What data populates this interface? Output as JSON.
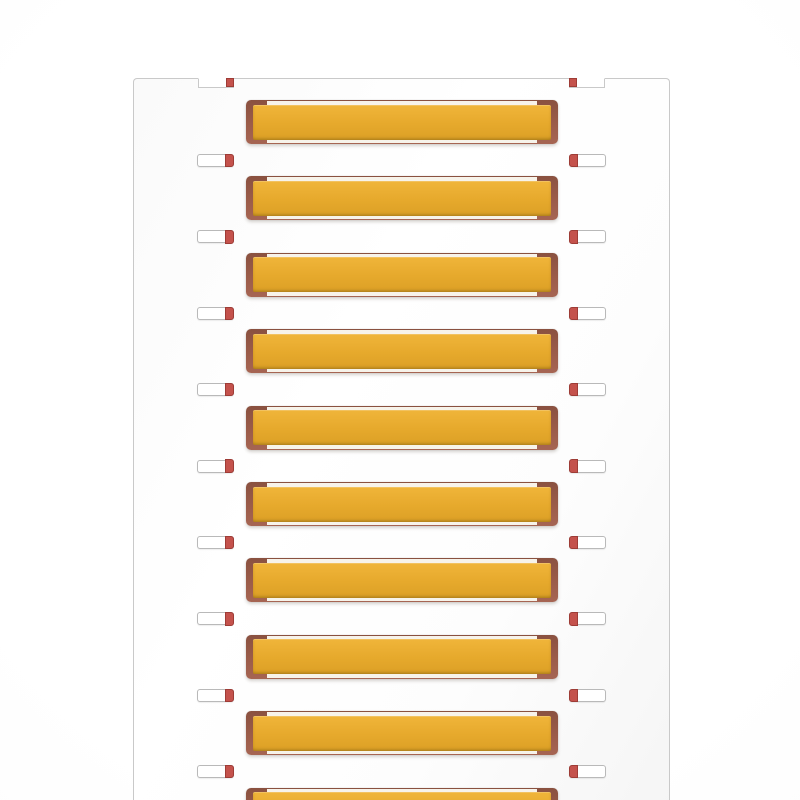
{
  "scene": {
    "description": "Blank yellow cable-marker strips mounted in holder frames on a white carrier card",
    "card": {
      "marker_rows_visible": 10,
      "side_tab_rows": 9,
      "top_notch_count": 2
    },
    "marker": {
      "printed_text": ""
    },
    "colors": {
      "background": "#ffffff",
      "card_fill": "#fdfdfd",
      "card_border": "#c9c9c9",
      "marker_yellow_top": "#f0b53a",
      "marker_yellow_mid": "#e6a92c",
      "marker_yellow_bottom": "#dca026",
      "holder_frame": "#9b5c49",
      "holder_frame_dark": "#8a5140",
      "holder_frame_light": "#a66553",
      "registration_red": "#c4524c",
      "tab_border": "#b9b9b9",
      "gap_sliver": "#f7f3ea"
    }
  }
}
